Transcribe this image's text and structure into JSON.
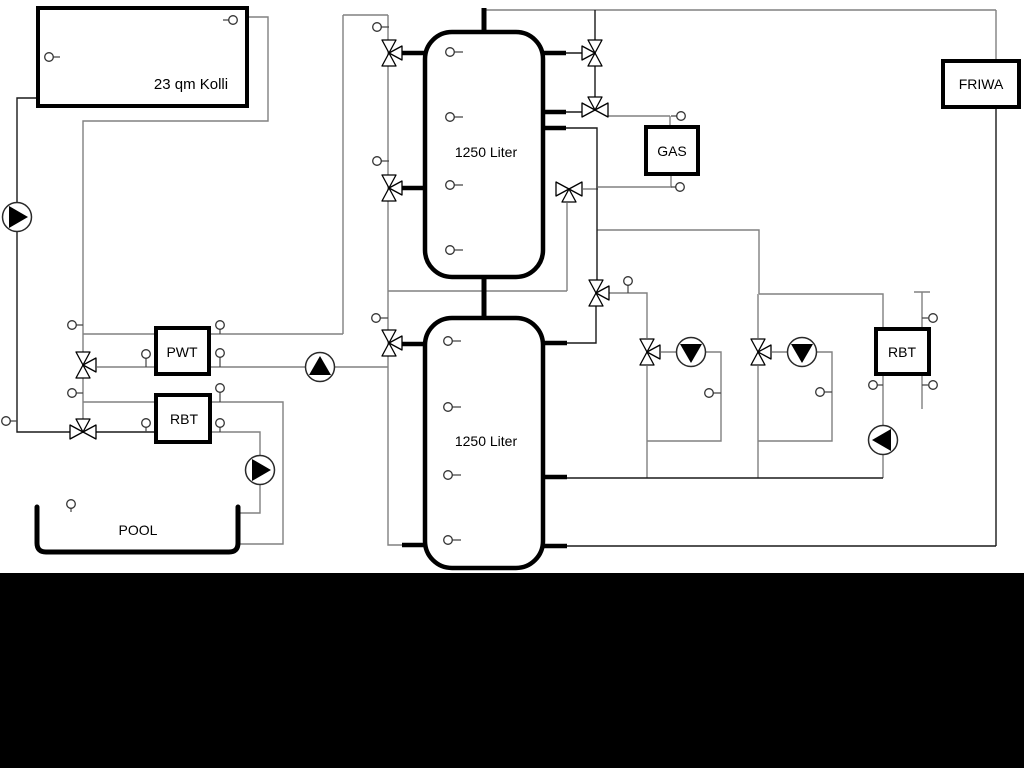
{
  "components": {
    "collector": {
      "label": "23 qm Kolli"
    },
    "tanks": [
      {
        "label": "1250 Liter"
      },
      {
        "label": "1250 Liter"
      }
    ],
    "boiler": {
      "label": "GAS"
    },
    "fresh_water_station": {
      "label": "FRIWA"
    },
    "heat_exchanger": {
      "label": "PWT"
    },
    "rbt_left": {
      "label": "RBT"
    },
    "rbt_right": {
      "label": "RBT"
    },
    "pool": {
      "label": "POOL"
    }
  },
  "colors": {
    "pipe_gray": "#808080",
    "pipe_black": "#1a1a1a",
    "background": "#ffffff",
    "footer_band": "#000000"
  }
}
